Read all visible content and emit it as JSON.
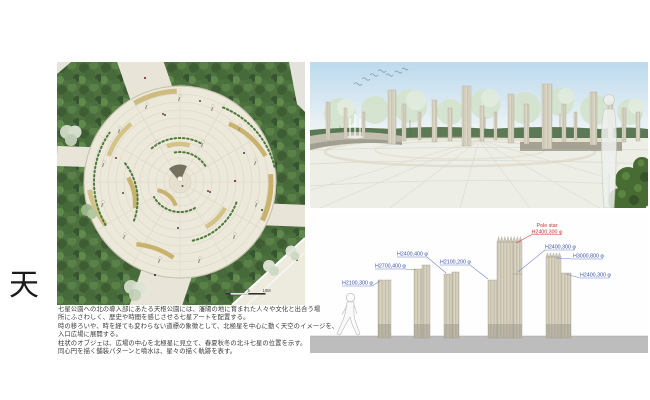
{
  "board": {
    "kanji": "天",
    "description_lines": [
      "七星公園への北の導入部にあたる天枢公園には、瀋陽の地に育まれた人々や文化と出合う場",
      "所にふさわしく、歴史や時間を感じさせる七星アートを配置する。",
      "時の移ろいや、時を経ても変わらない道標の象徴として、北極星を中心に動く天空のイメージを、",
      "入口広場に展開する。",
      "柱状のオブジェは、広場の中心を北極星に見立て、春夏秋冬の北斗七星の位置を示す。",
      "同心円を描く舗装パターンと噴水は、星々の描く軌跡を表す。"
    ]
  },
  "plan": {
    "scale_labels": [
      "0",
      "1",
      "5",
      "10M"
    ]
  },
  "elevation": {
    "pole_star_title": "Pole star",
    "columns": [
      {
        "spec": "H2100,300 φ"
      },
      {
        "spec": "H2700,400 φ"
      },
      {
        "spec": "H2400,400 φ"
      },
      {
        "spec": "H2100,200 φ"
      },
      {
        "spec": "H2400,300 φ",
        "note": "Pole star"
      },
      {
        "spec": "H3000,800 φ"
      },
      {
        "spec": "H2400,300 φ"
      }
    ],
    "label_color_blue": "#3a53b8",
    "label_color_red": "#d23434"
  }
}
